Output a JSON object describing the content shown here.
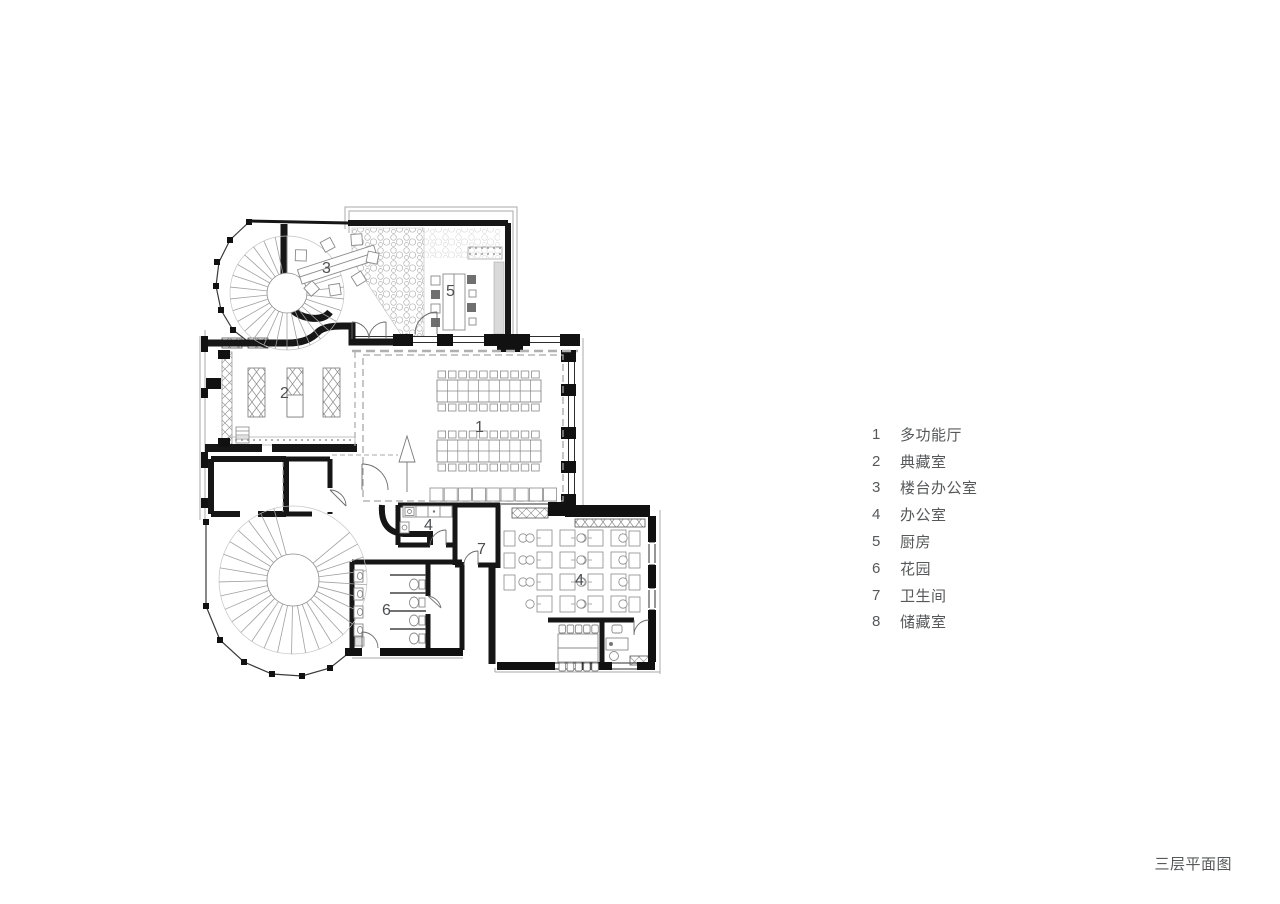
{
  "page": {
    "background": "#ffffff",
    "ink": "#1a1a1a",
    "text_color": "#57585a"
  },
  "plan": {
    "caption": "三层平面图",
    "room_numbers": {
      "hall": "1",
      "collection": "2",
      "terrace_office": "3",
      "pantry": "4",
      "kitchen": "5",
      "garden": "6",
      "bathroom": "7",
      "office": "4"
    }
  },
  "legend": {
    "items": [
      {
        "num": "1",
        "label": "多功能厅"
      },
      {
        "num": "2",
        "label": "典藏室"
      },
      {
        "num": "3",
        "label": "楼台办公室"
      },
      {
        "num": "4",
        "label": "办公室"
      },
      {
        "num": "5",
        "label": "厨房"
      },
      {
        "num": "6",
        "label": "花园"
      },
      {
        "num": "7",
        "label": "卫生间"
      },
      {
        "num": "8",
        "label": "储藏室"
      }
    ]
  }
}
